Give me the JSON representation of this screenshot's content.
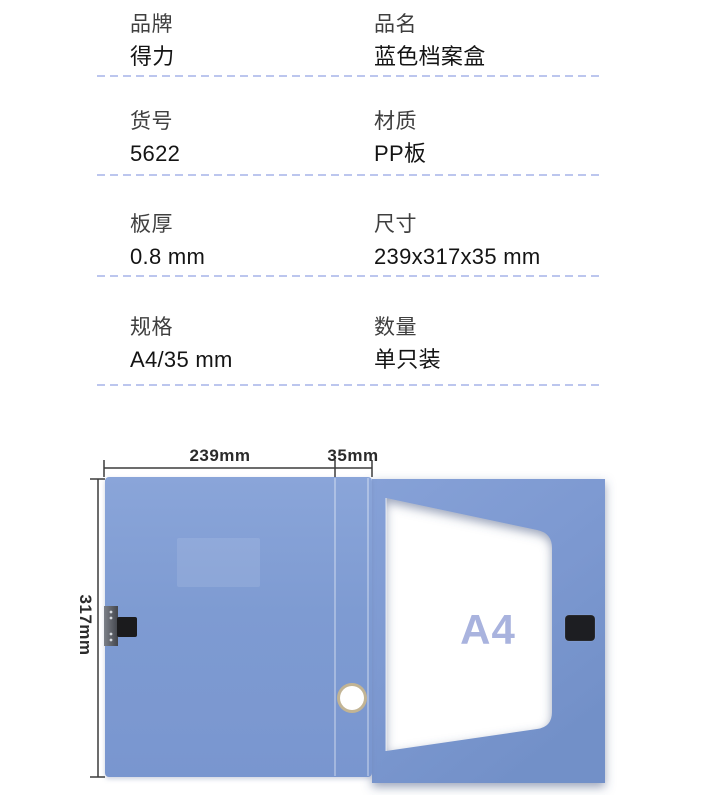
{
  "specs": {
    "rows": [
      {
        "left": {
          "label": "品牌",
          "value": "得力"
        },
        "right": {
          "label": "品名",
          "value": "蓝色档案盒"
        }
      },
      {
        "left": {
          "label": "货号",
          "value": "5622"
        },
        "right": {
          "label": "材质",
          "value": "PP板"
        }
      },
      {
        "left": {
          "label": "板厚",
          "value": "0.8 mm"
        },
        "right": {
          "label": "尺寸",
          "value": "239x317x35 mm"
        }
      },
      {
        "left": {
          "label": "规格",
          "value": "A4/35 mm"
        },
        "right": {
          "label": "数量",
          "value": "单只装"
        }
      }
    ]
  },
  "diagram": {
    "width_label": "239mm",
    "spine_label": "35mm",
    "height_label": "317mm",
    "paper_label": "A4"
  },
  "colors": {
    "panel_blue": "#7e9bd2",
    "panel_blue_light": "#8ba5da",
    "panel_blue_dark": "#7290c8",
    "divider_dash": "#bcc6ee",
    "label_text": "#3f3f3f",
    "value_text": "#141414",
    "a4_text": "#a9b3de",
    "dimension_text": "#2b2b2b",
    "hole_ring": "#c2b494"
  }
}
